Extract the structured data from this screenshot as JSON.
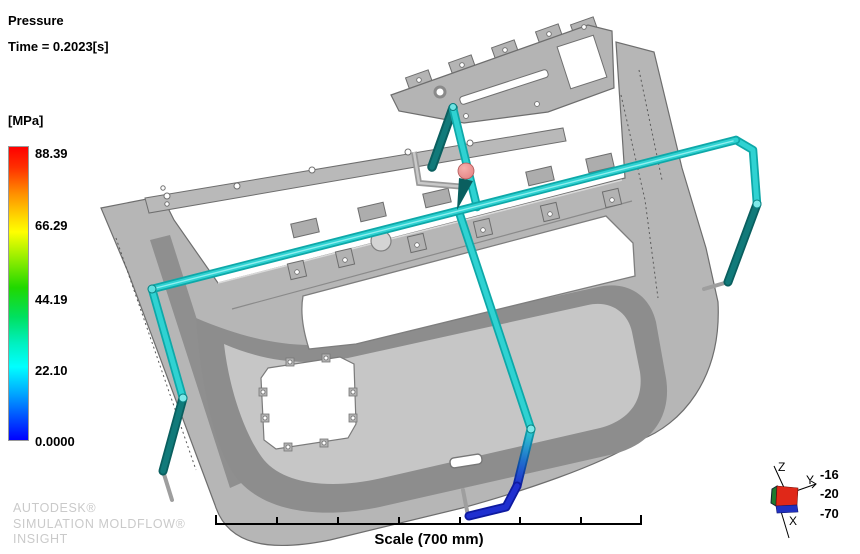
{
  "viewport": {
    "result_title": "Pressure",
    "time_label": "Time = 0.2023[s]"
  },
  "legend": {
    "unit_label": "[MPa]",
    "tick_values": [
      "88.39",
      "66.29",
      "44.19",
      "22.10",
      "0.0000"
    ],
    "gradient_top_color": "#FF0000",
    "gradient_bottom_color": "#0000FF"
  },
  "watermark": {
    "lines": [
      "AUTODESK®",
      "SIMULATION MOLDFLOW®",
      "INSIGHT"
    ]
  },
  "scale_bar": {
    "label": "Scale (700 mm)"
  },
  "triad": {
    "axis_x_label": "X",
    "axis_y_label": "Y",
    "axis_z_label": "Z",
    "readout_values": [
      "-16",
      "-20",
      "-70"
    ],
    "cube_top_color": "#E02818",
    "cube_left_color": "#1E7A2E",
    "cube_bottom_color": "#2030C0"
  },
  "model": {
    "part_color": "#B6B6B6",
    "runner_color": "#2FD2D2",
    "frozen_runner_color": "#117A7A",
    "low_pressure_runner_color": "#1F2FD0",
    "injection_marker_color": "#E98C8C"
  }
}
